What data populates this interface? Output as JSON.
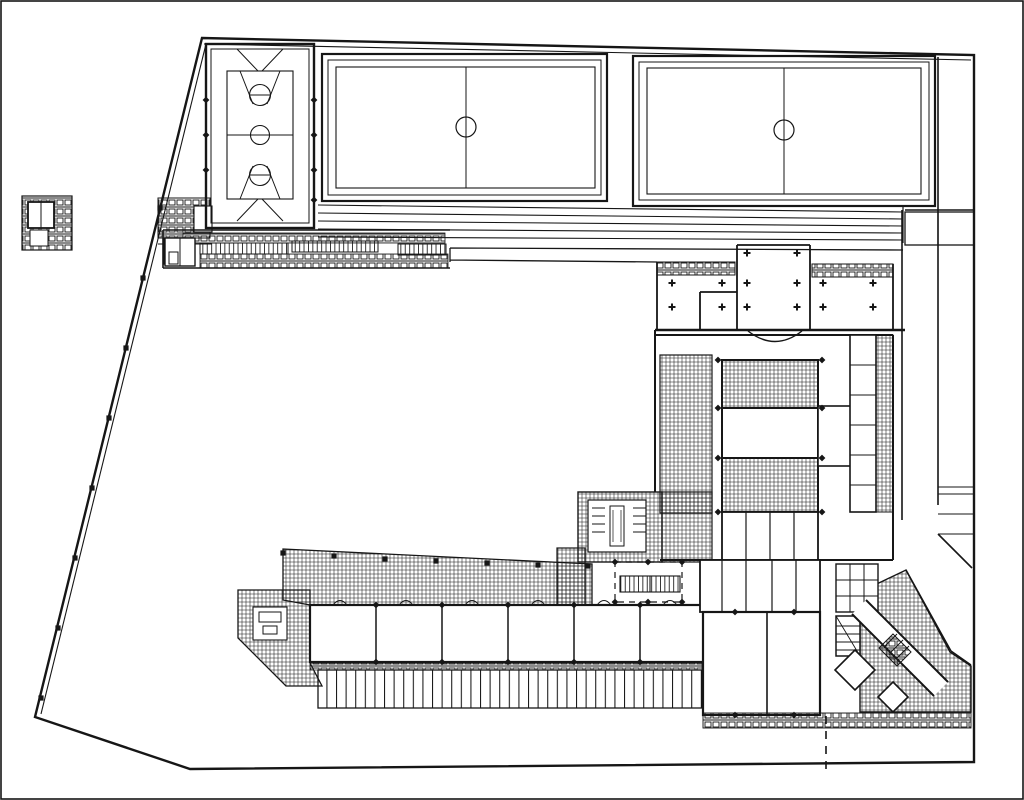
{
  "document": {
    "type": "architectural site plan",
    "description": "Black-and-white scanned ground-floor site plan of a school campus: three sports courts at the top, terraced steps, a low north wing, a main teaching block with colonnade and hatched halls, a six-classroom south wing, paved cross-hatched terraces and a diagonal corner stair at the south-east, all inside an irregular plot with a slanted west fence.",
    "view": "plan view, black ink on white paper"
  },
  "palette": {
    "ink": "#161616",
    "paper": "#ffffff"
  },
  "features": {
    "courts": [
      {
        "id": "basketball-court",
        "label": "Basketball court with centre circle, two free-throw circles and trapezoid keys"
      },
      {
        "id": "games-court-west",
        "label": "Games court with halfway line and centre circle"
      },
      {
        "id": "games-court-east",
        "label": "Games court with halfway line and centre circle"
      }
    ],
    "site": {
      "boundary": "Irregular five-sided plot, slanted double-line west fence",
      "fence_posts": 8,
      "dashed_setback_line": true,
      "perimeter_path": "Path strip along east boundary with steps and diagonal end"
    },
    "buildings": [
      {
        "id": "north-wing",
        "label": "Low north service wing (changing rooms) with paved hatch bands",
        "cells": 3
      },
      {
        "id": "main-building",
        "label": "Main teaching block: open colonnade, two cross-hatched halls, corridor strips and stair/WC core",
        "colonnade_columns": 14
      },
      {
        "id": "classroom-wing",
        "label": "South classroom wing",
        "classrooms": 6
      },
      {
        "id": "south-east-wing",
        "label": "South-east wing with scissor stair, diagonal stair corridor and corner rooms"
      },
      {
        "id": "gate-structure",
        "label": "Small gate structure at west boundary corner"
      },
      {
        "id": "detached-kiosk",
        "label": "Small detached hatched structure outside west fence"
      }
    ],
    "landscape": [
      {
        "id": "terraced-steps",
        "label": "Terraced steps below the courts",
        "step_lines": 5
      },
      {
        "id": "paved-terrace",
        "label": "Cross-hatched paved terrace with pergola posts",
        "pergola_posts": 7,
        "inset": "small planter/table symbol"
      },
      {
        "id": "pergola-strip",
        "label": "Striped shelter / bicycle stand strip",
        "bays": 40
      },
      {
        "id": "courtyard",
        "label": "Large open courtyard (unpaved)"
      },
      {
        "id": "corner-plaza",
        "label": "Cross-hatched south-east corner plaza"
      }
    ]
  }
}
